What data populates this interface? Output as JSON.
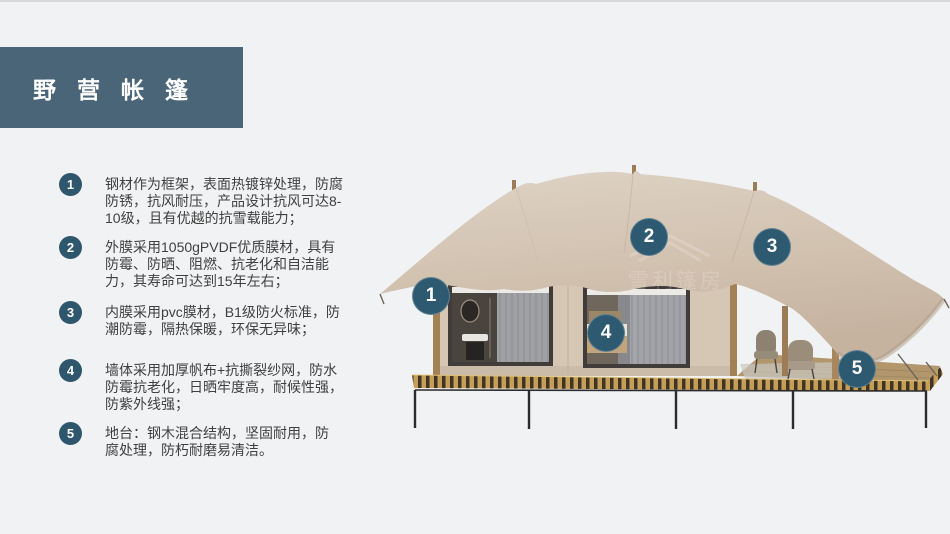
{
  "page": {
    "background": "#f1f2f3"
  },
  "title": {
    "text": "野营帐篷"
  },
  "features": [
    {
      "number": "1",
      "text": "钢材作为框架，表面热镀锌处理，防腐\n防锈，抗风耐压，产品设计抗风可达8-\n10级，且有优越的抗雪载能力；"
    },
    {
      "number": "2",
      "text": "外膜采用1050gPVDF优质膜材，具有\n防霉、防晒、阻燃、抗老化和自洁能\n力，其寿命可达到15年左右；"
    },
    {
      "number": "3",
      "text": "内膜采用pvc膜材，B1级防火标准，防\n潮防霉，隔热保暖，环保无异味；"
    },
    {
      "number": "4",
      "text": "墙体采用加厚帆布+抗撕裂纱网，防水\n防霉抗老化，日晒牢度高，耐候性强，\n防紫外线强；"
    },
    {
      "number": "5",
      "text": "地台：钢木混合结构，坚固耐用，防\n腐处理，防朽耐磨易清洁。"
    }
  ],
  "tent": {
    "watermark": "雪利篷房",
    "callouts": [
      {
        "label": "1"
      },
      {
        "label": "2"
      },
      {
        "label": "3"
      },
      {
        "label": "4"
      },
      {
        "label": "5"
      }
    ],
    "colors": {
      "accent_badge": "#2e566c",
      "callout": "#2d5971",
      "title_bar": "#4a6478",
      "canopy": "#d3c4b3",
      "wall": "#d5c7b4",
      "deck_gold": "#c79e55",
      "deck_dark": "#3f3526"
    }
  }
}
